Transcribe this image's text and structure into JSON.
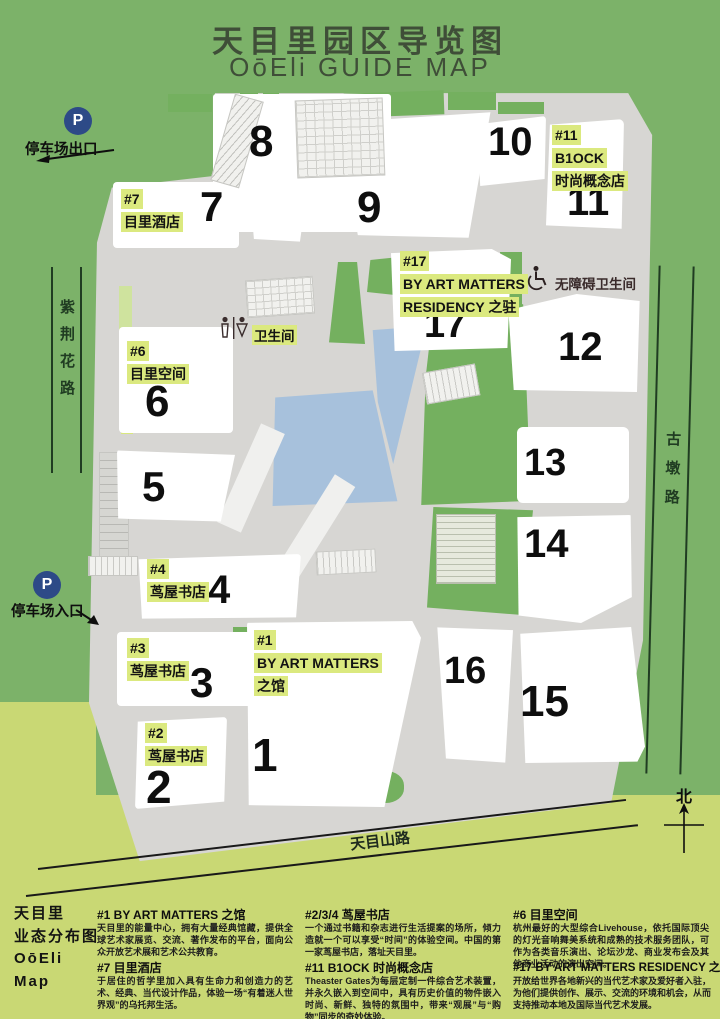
{
  "title": {
    "zh": "天目里园区导览图",
    "en": "OōEli GUIDE MAP"
  },
  "map": {
    "buildings": [
      {
        "num": "1",
        "label_lines": [
          "#1",
          "BY ART MATTERS",
          "之馆"
        ]
      },
      {
        "num": "2",
        "label_lines": [
          "#2",
          "茑屋书店"
        ]
      },
      {
        "num": "3",
        "label_lines": [
          "#3",
          "茑屋书店"
        ]
      },
      {
        "num": "4",
        "label_lines": [
          "#4",
          "茑屋书店"
        ]
      },
      {
        "num": "5",
        "label_lines": []
      },
      {
        "num": "6",
        "label_lines": [
          "#6",
          "目里空间"
        ]
      },
      {
        "num": "7",
        "label_lines": [
          "#7",
          "目里酒店"
        ]
      },
      {
        "num": "8",
        "label_lines": []
      },
      {
        "num": "9",
        "label_lines": []
      },
      {
        "num": "10",
        "label_lines": []
      },
      {
        "num": "11",
        "label_lines": [
          "#11",
          "B1OCK",
          "时尚概念店"
        ]
      },
      {
        "num": "12",
        "label_lines": []
      },
      {
        "num": "13",
        "label_lines": []
      },
      {
        "num": "14",
        "label_lines": []
      },
      {
        "num": "15",
        "label_lines": []
      },
      {
        "num": "16",
        "label_lines": []
      },
      {
        "num": "17",
        "label_lines": [
          "#17",
          "BY ART MATTERS",
          "RESIDENCY 之驻"
        ]
      }
    ],
    "roads": {
      "left": "紫荆花路",
      "right": "古墩路",
      "bottom": "天目山路"
    },
    "markers": {
      "parking_symbol": "P",
      "parking_exit": "停车场出口",
      "parking_entrance": "停车场入口",
      "toilet": "卫生间",
      "accessible_toilet": "无障碍卫生间",
      "compass_north": "北"
    }
  },
  "legend": {
    "title_lines": [
      "天目里",
      "业态分布图",
      "OōEli",
      "Map"
    ],
    "entries": [
      {
        "heading": "#1 BY ART MATTERS 之馆",
        "body": "天目里的能量中心，拥有大量经典馆藏，提供全球艺术家展览、交流、著作发布的平台，面向公众开放艺术展和艺术公共教育。"
      },
      {
        "heading": "#7 目里酒店",
        "body": "于居住的哲学里加入具有生命力和创造力的艺术、经典、当代设计作品，体验一场“有着迷人世界观”的乌托邦生活。"
      },
      {
        "heading": "#2/3/4 茑屋书店",
        "body": "一个通过书籍和杂志进行生活提案的场所，倾力造就一个可以享受“时间”的体验空间。中国的第一家茑屋书店，落址天目里。"
      },
      {
        "heading": "#11 B1OCK 时尚概念店",
        "body": "Theaster Gates为每层定制一件综合艺术装置，并永久嵌入到空间中，具有历史价值的物件嵌入时尚、新鲜、独特的氛围中，带来“观展”与“购物”同步的奇妙体验。"
      },
      {
        "heading": "#6 目里空间",
        "body": "杭州最好的大型综合Livehouse，依托国际顶尖的灯光音响舞美系统和成熟的技术服务团队，可作为各类音乐演出、论坛沙龙、商业发布会及其他商业活动的演出空间。"
      },
      {
        "heading": "#17 BY ART MATTERS RESIDENCY 之驻",
        "body": "开放给世界各地新兴的当代艺术家及爱好者入驻，为他们提供创作、展示、交流的环境和机会，从而支持推动本地及国际当代艺术发展。"
      }
    ]
  },
  "colors": {
    "background_green": "#7cb269",
    "bottom_band_green": "#c9d874",
    "plaza_gray": "#d7d6d3",
    "pond_blue": "#a7c1dc",
    "label_highlight": "#dbe97f",
    "parking_badge_navy": "#2d4a87",
    "title_green": "#3f4e38"
  }
}
